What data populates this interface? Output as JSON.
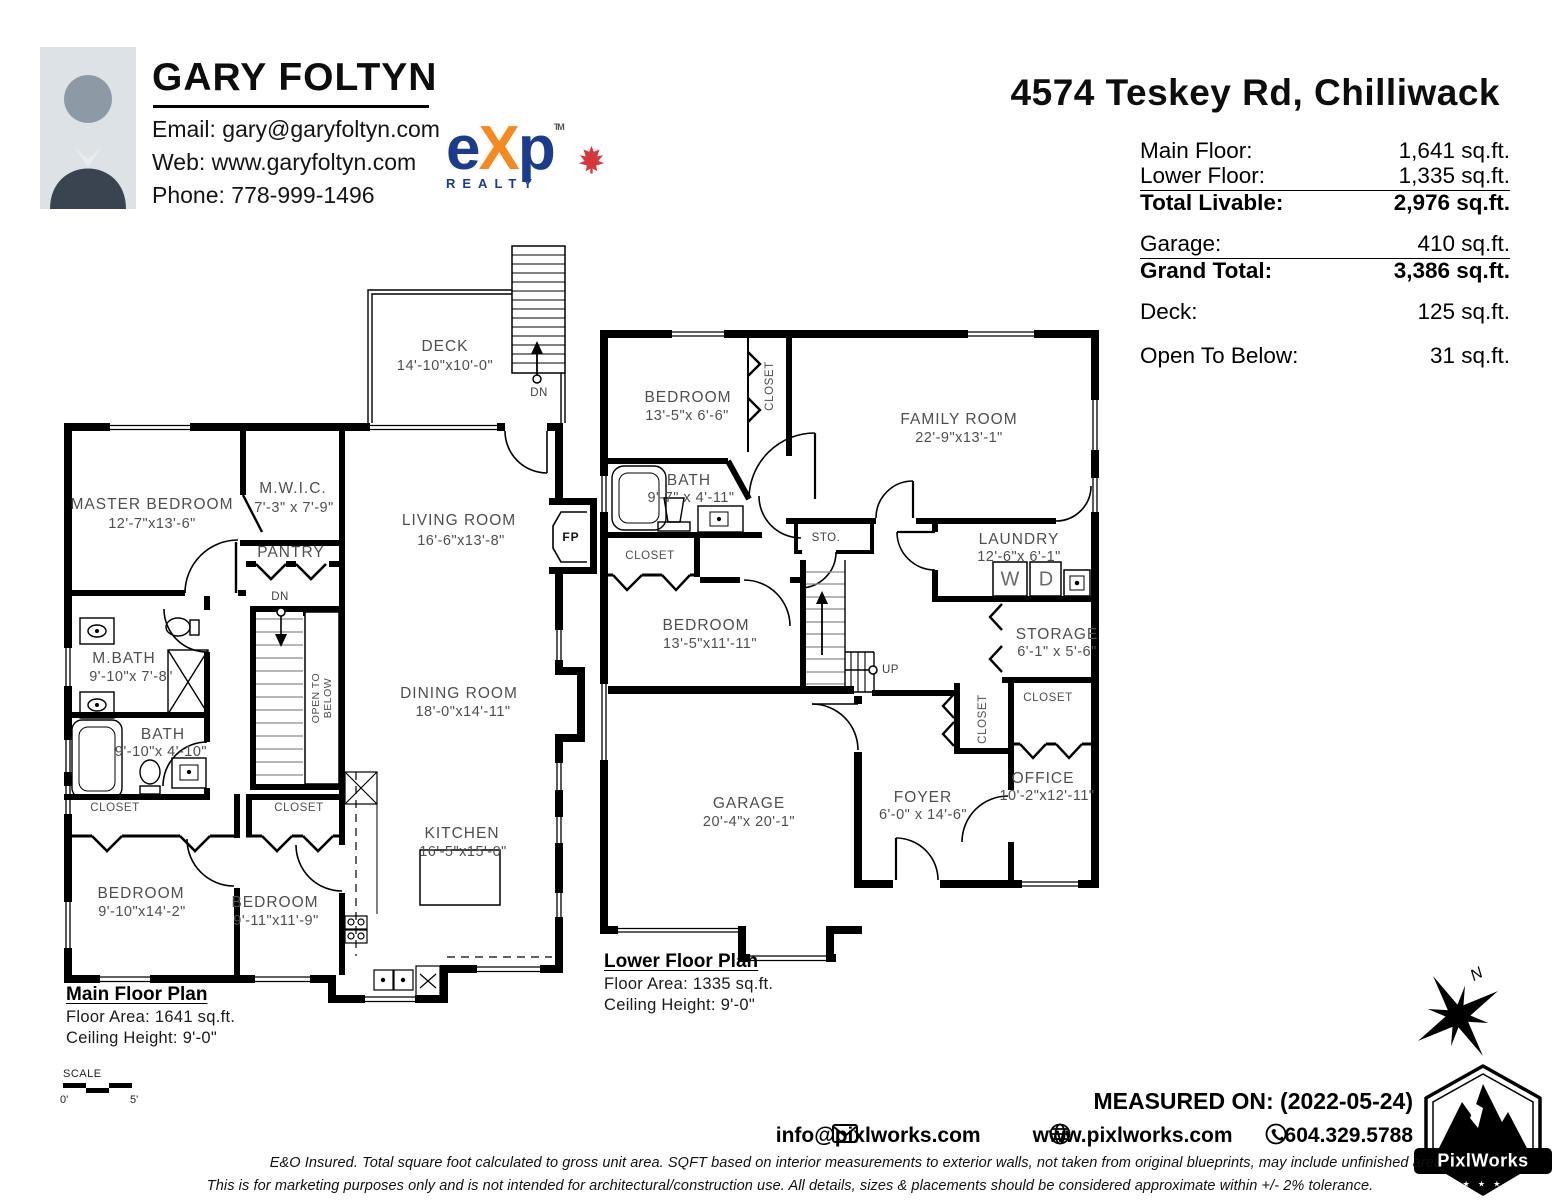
{
  "header": {
    "agent_name": "GARY FOLTYN",
    "email": "Email: gary@garyfoltyn.com",
    "web": "Web: www.garyfoltyn.com",
    "phone": "Phone: 778-999-1496",
    "brokerage_e": "e",
    "brokerage_x": "X",
    "brokerage_p": "p",
    "brokerage_sub": "REALTY",
    "brokerage_tm": "TM",
    "address": "4574 Teskey Rd, Chilliwack",
    "colors": {
      "exp_blue": "#1b3c8c",
      "exp_orange": "#f6891f",
      "maple_red": "#d6373b"
    }
  },
  "area_table": {
    "rows": [
      {
        "label": "Main Floor:",
        "value": "1,641 sq.ft."
      },
      {
        "label": "Lower Floor:",
        "value": "1,335 sq.ft."
      },
      {
        "label": "Total Livable:",
        "value": "2,976 sq.ft."
      },
      {
        "label": "Garage:",
        "value": "410 sq.ft."
      },
      {
        "label": "Grand Total:",
        "value": "3,386 sq.ft."
      },
      {
        "label": "Deck:",
        "value": "125 sq.ft."
      },
      {
        "label": "Open To Below:",
        "value": "31 sq.ft."
      }
    ]
  },
  "main_floor": {
    "title": "Main Floor Plan",
    "floor_area": "Floor Area: 1641 sq.ft.",
    "ceiling_height": "Ceiling Height: 9'-0\"",
    "rooms": [
      {
        "name": "MASTER BEDROOM",
        "dims": "12'-7\"x13'-6\""
      },
      {
        "name": "M.W.I.C.",
        "dims": "7'-3\" x 7'-9\""
      },
      {
        "name": "PANTRY"
      },
      {
        "name": "LIVING ROOM",
        "dims": "16'-6\"x13'-8\""
      },
      {
        "name": "DECK",
        "dims": "14'-10\"x10'-0\""
      },
      {
        "name": "M.BATH",
        "dims": "9'-10\"x 7'-8\""
      },
      {
        "name": "BATH",
        "dims": "9'-10\"x 4'-10\""
      },
      {
        "name": "CLOSET"
      },
      {
        "name": "CLOSET"
      },
      {
        "name": "BEDROOM",
        "dims": "9'-10\"x14'-2\""
      },
      {
        "name": "BEDROOM",
        "dims": "9'-11\"x11'-9\""
      },
      {
        "name": "DINING ROOM",
        "dims": "18'-0\"x14'-11\""
      },
      {
        "name": "KITCHEN",
        "dims": "16'-5\"x15'-0\""
      }
    ],
    "markers": {
      "deck_dn": "DN",
      "stairs_dn": "DN",
      "fireplace": "FP",
      "open_to_below": "OPEN TO BELOW"
    }
  },
  "lower_floor": {
    "title": "Lower Floor Plan",
    "floor_area": "Floor Area: 1335 sq.ft.",
    "ceiling_height": "Ceiling Height: 9'-0\"",
    "rooms": [
      {
        "name": "BEDROOM",
        "dims": "13'-5\"x 6'-6\""
      },
      {
        "name": "FAMILY ROOM",
        "dims": "22'-9\"x13'-1\""
      },
      {
        "name": "BATH",
        "dims": "9'-7\" x 4'-11\""
      },
      {
        "name": "BEDROOM",
        "dims": "13'-5\"x11'-11\""
      },
      {
        "name": "LAUNDRY",
        "dims": "12'-6\"x 6'-1\""
      },
      {
        "name": "STORAGE",
        "dims": "6'-1\" x 5'-6\""
      },
      {
        "name": "GARAGE",
        "dims": "20'-4\"x 20'-1\""
      },
      {
        "name": "FOYER",
        "dims": "6'-0\" x 14'-6\""
      },
      {
        "name": "OFFICE",
        "dims": "10'-2\"x12'-11\""
      },
      {
        "name": "CLOSET"
      },
      {
        "name": "CLOSET"
      },
      {
        "name": "CLOSET"
      },
      {
        "name": "CLOSET"
      }
    ],
    "markers": {
      "up": "UP",
      "sto": "STO.",
      "washer": "W",
      "dryer": "D"
    }
  },
  "footer": {
    "scale_label": "SCALE",
    "scale_start": "0'",
    "scale_end": "5'",
    "measured_on": "MEASURED ON: (2022-05-24)",
    "email": "info@pixlworks.com",
    "website": "www.pixlworks.com",
    "phone": "604.329.5788",
    "disclaimer_line1": "E&O Insured.  Total square foot calculated to gross unit area. SQFT based on interior measurements to exterior walls, not taken from original blueprints, may include unfinished area.",
    "disclaimer_line2": "This is for marketing purposes only and is not intended for architectural/construction use.  All details, sizes & placements should be considered approximate within +/- 2%  tolerance.",
    "logo_text": "PixlWorks",
    "compass_n": "N"
  }
}
